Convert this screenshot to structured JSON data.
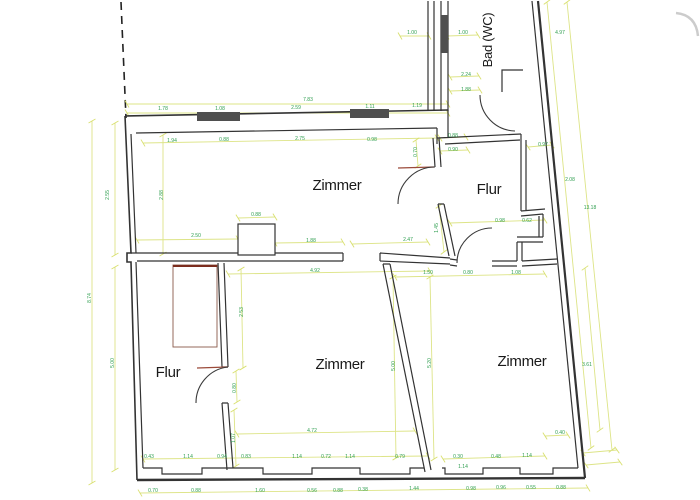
{
  "title": "Grundriss (floor plan)",
  "colors": {
    "background": "#ffffff",
    "wall": "#333333",
    "dim_line": "#dde487",
    "tick": "#d9e06f",
    "dim_text": "#2e9e4f",
    "timber": "#8a5a4a",
    "timber_dark": "#7c2d1e",
    "threshold": "#9b4a3a",
    "window": "#4f4f4f",
    "room_text": "#1a1a1a",
    "artifact": "#cccccc",
    "dash": "#222222"
  },
  "canvas": {
    "width": 700,
    "height": 500
  },
  "rooms": [
    {
      "label": "Zimmer",
      "x": 337,
      "y": 190,
      "fs": 15
    },
    {
      "label": "Flur",
      "x": 489,
      "y": 194,
      "fs": 15
    },
    {
      "label": "Bad (WC)",
      "x": 492,
      "y": 40,
      "fs": 13,
      "r": -90
    },
    {
      "label": "Flur",
      "x": 168,
      "y": 377,
      "fs": 15
    },
    {
      "label": "Zimmer",
      "x": 340,
      "y": 369,
      "fs": 15
    },
    {
      "label": "Zimmer",
      "x": 522,
      "y": 366,
      "fs": 15
    }
  ],
  "plan": {
    "dashed_line": {
      "d": "M121,2 L126,118"
    },
    "artifact": {
      "d": "M676,13 Q696,15 698,36"
    },
    "walls": [
      {
        "d": "M125,116 L448,110",
        "w": 1.6
      },
      {
        "d": "M136,133 L437,128",
        "w": 1.2
      },
      {
        "d": "M125,116 L131,253 L127,253 L127,262 L131,262 L137,480",
        "w": 1.6
      },
      {
        "d": "M131,134 L136,253 M136,262 L143,468",
        "w": 1.2
      },
      {
        "d": "M137,480 L585,478",
        "w": 2.4
      },
      {
        "d": "M143,468 L162,468 L162,474 L202,474 L202,468 L263,468 L263,474 L312,474 L312,468 L360,468 L360,474 L410,474 L410,468 L424,468 M442,468 L445,468 L445,474 L483,474 L483,468 L520,468 L520,474 L553,474 L553,468 L578,468",
        "w": 1.2
      },
      {
        "d": "M538,1 L585,478",
        "w": 2.2
      },
      {
        "d": "M532,1 L578,468",
        "w": 1.2
      },
      {
        "d": "M428,1 L428,111 M434,1 L434,111",
        "w": 1.2
      },
      {
        "d": "M441,1 L441,111 M448,1 L448,111",
        "w": 1.2
      },
      {
        "d": "M523,70 L502,70 L502,92",
        "w": 1.2
      },
      {
        "d": "M437,128 L437,144 M437,138 L521,134 M445,144 L520,140 M448,110 L448,138",
        "w": 1.2
      },
      {
        "d": "M433,138 L435,167 M439,138 L441,167",
        "w": 1.2
      },
      {
        "d": "M438,204 L449,256 M444,204 L455,256 M438,204 L444,204",
        "w": 1.2
      },
      {
        "d": "M521,134 L521,211 M526,140 L526,211 M521,211 L545,209 M521,216 L543,214 M543,214 L543,237 M539,216 L539,237 M517,237 L543,237 M517,242 L543,242 M517,242 L517,261 M522,242 L522,261",
        "w": 1.2
      },
      {
        "d": "M450,259 L457,260 M450,265 L457,266 M492,261 L517,261 M492,266 L517,266 M522,261 L557,259 M522,266 L557,264",
        "w": 1.2
      },
      {
        "d": "M131,253 L343,253 M137,261 L343,261 M343,253 L343,261 M380,253 L380,261 M380,253 L450,258 M380,261 L450,264",
        "w": 1.2
      },
      {
        "d": "M383,264 L425,472 M390,264 L431,470 M383,264 L390,264",
        "w": 1.2
      },
      {
        "d": "M218,263 L222,367 M224,263 L228,367 M222,367 L228,367 M222,403 L227,470 M228,403 L233,468 M222,403 L228,403",
        "w": 1.2
      }
    ],
    "column": {
      "x": 238,
      "y": 224,
      "w": 37,
      "h": 31
    },
    "wardrobe": {
      "x": 173,
      "y": 265,
      "w": 44,
      "h": 82
    },
    "windows": [
      {
        "x": 197,
        "y": 112,
        "w": 43,
        "h": 9
      },
      {
        "x": 350,
        "y": 109,
        "w": 39,
        "h": 9
      },
      {
        "x": 441,
        "y": 15,
        "w": 7,
        "h": 38
      }
    ],
    "timber": [
      {
        "d": "M173,266 L217,266",
        "w": 2,
        "dark": true
      },
      {
        "d": "M398,168 L434,167",
        "w": 1.2,
        "dark": false
      },
      {
        "d": "M197,368 L228,367",
        "w": 1.2,
        "dark": false
      }
    ],
    "arcs": [
      {
        "d": "M398,204 A37,37 0 0 1 435,167"
      },
      {
        "d": "M480,95 A36,36 0 0 0 515,131"
      },
      {
        "d": "M457,263 A35,35 0 0 1 492,228"
      },
      {
        "d": "M196,403 A36,36 0 0 1 228,367"
      }
    ],
    "dim_lines": [
      [
        127,
        104,
        448,
        104
      ],
      [
        127,
        113,
        448,
        113
      ],
      [
        143,
        143,
        437,
        138
      ],
      [
        400,
        36,
        429,
        36
      ],
      [
        447,
        36,
        478,
        35
      ],
      [
        450,
        77,
        479,
        76
      ],
      [
        450,
        91,
        480,
        90
      ],
      [
        440,
        138,
        466,
        137
      ],
      [
        440,
        151,
        468,
        150
      ],
      [
        528,
        147,
        552,
        145
      ],
      [
        450,
        223,
        545,
        220
      ],
      [
        547,
        2,
        591,
        448
      ],
      [
        567,
        2,
        612,
        450
      ],
      [
        238,
        218,
        275,
        217
      ],
      [
        137,
        240,
        238,
        239
      ],
      [
        275,
        243,
        343,
        242
      ],
      [
        352,
        244,
        428,
        242
      ],
      [
        439,
        206,
        444,
        252
      ],
      [
        416,
        140,
        418,
        166
      ],
      [
        92,
        121,
        92,
        483
      ],
      [
        115,
        123,
        115,
        255
      ],
      [
        115,
        267,
        115,
        470
      ],
      [
        163,
        135,
        163,
        254
      ],
      [
        228,
        274,
        430,
        271
      ],
      [
        395,
        277,
        545,
        274
      ],
      [
        241,
        269,
        243,
        368
      ],
      [
        236,
        371,
        237,
        402
      ],
      [
        234,
        410,
        236,
        466
      ],
      [
        393,
        277,
        396,
        458
      ],
      [
        430,
        277,
        434,
        459
      ],
      [
        585,
        268,
        600,
        430
      ],
      [
        545,
        436,
        568,
        435
      ],
      [
        237,
        434,
        415,
        431
      ],
      [
        143,
        459,
        428,
        456
      ],
      [
        443,
        459,
        545,
        456
      ],
      [
        140,
        493,
        588,
        488
      ],
      [
        583,
        453,
        617,
        450
      ],
      [
        586,
        465,
        620,
        462
      ]
    ],
    "dims": [
      {
        "v": "7.83",
        "x": 308,
        "y": 101
      },
      {
        "v": "1.78",
        "x": 163,
        "y": 110
      },
      {
        "v": "1.08",
        "x": 220,
        "y": 110
      },
      {
        "v": "2.59",
        "x": 296,
        "y": 109
      },
      {
        "v": "1.11",
        "x": 370,
        "y": 108
      },
      {
        "v": "1.19",
        "x": 417,
        "y": 107
      },
      {
        "v": "1.94",
        "x": 172,
        "y": 142
      },
      {
        "v": "0.88",
        "x": 224,
        "y": 141
      },
      {
        "v": "2.75",
        "x": 300,
        "y": 140
      },
      {
        "v": "0.98",
        "x": 372,
        "y": 141
      },
      {
        "v": "0.70",
        "x": 417,
        "y": 152,
        "r": -90
      },
      {
        "v": "0.88",
        "x": 453,
        "y": 137
      },
      {
        "v": "0.90",
        "x": 453,
        "y": 151
      },
      {
        "v": "1.00",
        "x": 412,
        "y": 34
      },
      {
        "v": "1.00",
        "x": 463,
        "y": 34
      },
      {
        "v": "2.24",
        "x": 466,
        "y": 76
      },
      {
        "v": "1.88",
        "x": 466,
        "y": 91
      },
      {
        "v": "4.97",
        "x": 560,
        "y": 34
      },
      {
        "v": "0.97",
        "x": 543,
        "y": 146
      },
      {
        "v": "2.08",
        "x": 570,
        "y": 181
      },
      {
        "v": "13.18",
        "x": 590,
        "y": 209
      },
      {
        "v": "0.98",
        "x": 500,
        "y": 222
      },
      {
        "v": "0.62",
        "x": 527,
        "y": 222
      },
      {
        "v": "0.88",
        "x": 256,
        "y": 216
      },
      {
        "v": "2.50",
        "x": 196,
        "y": 237
      },
      {
        "v": "1.88",
        "x": 311,
        "y": 242
      },
      {
        "v": "2.47",
        "x": 408,
        "y": 241
      },
      {
        "v": "1.45",
        "x": 438,
        "y": 228,
        "r": -90
      },
      {
        "v": "2.55",
        "x": 109,
        "y": 195,
        "r": -90
      },
      {
        "v": "2.88",
        "x": 163,
        "y": 195,
        "r": -90
      },
      {
        "v": "8.74",
        "x": 91,
        "y": 298,
        "r": -90
      },
      {
        "v": "5.00",
        "x": 114,
        "y": 363,
        "r": -90
      },
      {
        "v": "4.92",
        "x": 315,
        "y": 272
      },
      {
        "v": "2.53",
        "x": 243,
        "y": 312,
        "r": -90
      },
      {
        "v": "0.80",
        "x": 236,
        "y": 388,
        "r": -90
      },
      {
        "v": "1.07",
        "x": 235,
        "y": 438,
        "r": -90
      },
      {
        "v": "5.00",
        "x": 395,
        "y": 366,
        "r": -90
      },
      {
        "v": "5.20",
        "x": 431,
        "y": 363,
        "r": -90
      },
      {
        "v": "3.61",
        "x": 587,
        "y": 366
      },
      {
        "v": "0.40",
        "x": 560,
        "y": 434
      },
      {
        "v": "1.50",
        "x": 428,
        "y": 274
      },
      {
        "v": "0.80",
        "x": 468,
        "y": 274
      },
      {
        "v": "1.08",
        "x": 516,
        "y": 274
      },
      {
        "v": "4.72",
        "x": 312,
        "y": 432
      },
      {
        "v": "0.43",
        "x": 149,
        "y": 458
      },
      {
        "v": "1.14",
        "x": 188,
        "y": 458
      },
      {
        "v": "0.94",
        "x": 222,
        "y": 458
      },
      {
        "v": "0.83",
        "x": 246,
        "y": 458
      },
      {
        "v": "1.14",
        "x": 297,
        "y": 458
      },
      {
        "v": "0.72",
        "x": 326,
        "y": 458
      },
      {
        "v": "1.14",
        "x": 350,
        "y": 458
      },
      {
        "v": "0.79",
        "x": 400,
        "y": 458
      },
      {
        "v": "0.30",
        "x": 458,
        "y": 458
      },
      {
        "v": "0.48",
        "x": 496,
        "y": 458
      },
      {
        "v": "1.14",
        "x": 527,
        "y": 457
      },
      {
        "v": "1.14",
        "x": 463,
        "y": 468
      },
      {
        "v": "0.70",
        "x": 153,
        "y": 492
      },
      {
        "v": "0.88",
        "x": 196,
        "y": 492
      },
      {
        "v": "1.60",
        "x": 260,
        "y": 492
      },
      {
        "v": "0.56",
        "x": 312,
        "y": 492
      },
      {
        "v": "0.88",
        "x": 338,
        "y": 492
      },
      {
        "v": "0.38",
        "x": 363,
        "y": 491
      },
      {
        "v": "1.44",
        "x": 414,
        "y": 490
      },
      {
        "v": "0.98",
        "x": 471,
        "y": 490
      },
      {
        "v": "0.96",
        "x": 501,
        "y": 489
      },
      {
        "v": "0.55",
        "x": 531,
        "y": 489
      },
      {
        "v": "0.88",
        "x": 561,
        "y": 489
      }
    ]
  }
}
